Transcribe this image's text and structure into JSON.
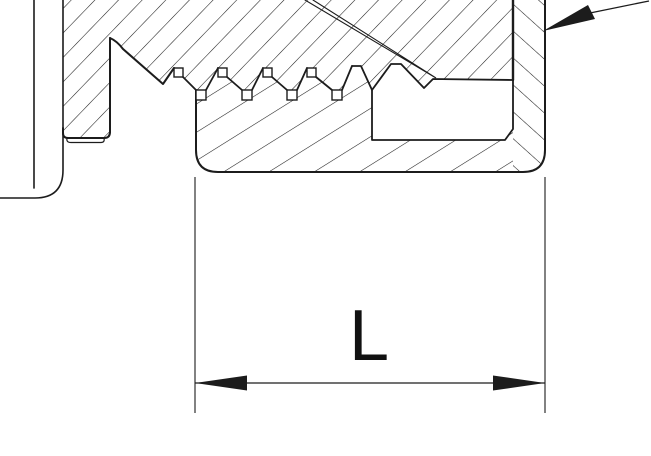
{
  "drawing": {
    "kind": "sectional technical drawing of a threaded plug in a housing",
    "dimension": {
      "label": "L"
    },
    "icons": {
      "dimension_arrow_left": "filled-arrowhead-left",
      "dimension_arrow_right": "filled-arrowhead-right",
      "leader_arrow": "filled-arrowhead-pointing-lower-left",
      "thin_pointer": "converging-twin-line-pointer"
    },
    "colors": {
      "background": "#ffffff",
      "line": "#1c1c1c"
    }
  }
}
